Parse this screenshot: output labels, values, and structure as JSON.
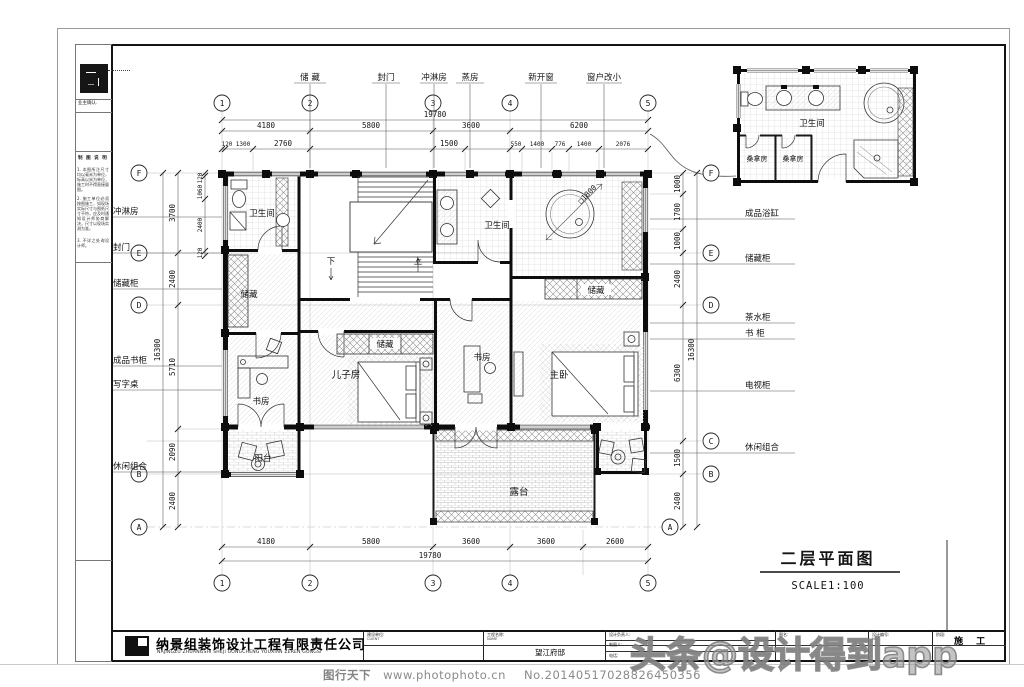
{
  "footer": {
    "brand": "图行天下",
    "url": "www.photophoto.cn",
    "serial": "No.20140517028826450356"
  },
  "watermark": {
    "text": "头条@设计得到app"
  },
  "title_tag": {
    "title": "二层平面图",
    "scale": "SCALE1:100"
  },
  "sidebar": {
    "confirm": "业主确认.",
    "notes_title": "制 图 说 明",
    "notes": [
      "1. 本图所注尺寸均以毫米为单位，标高以米为单位，施工时不得直接量图。",
      "2. 施工单位必须按图施工，如现场实际尺寸与图纸尺寸不符，应及时通知设计师协商解决，尺寸以现场实测为准。",
      "3. 不详之处询设计师。"
    ]
  },
  "titleblock": {
    "company": "纳景组装饰设计工程有限责任公司",
    "company_en": "NAJINGZU ZHUANGSHI SHEJI GONGCHENG YOUXIAN ZEREN GONGSI",
    "client_label": "建设单位:",
    "client_sub": "CLIENT",
    "project_label": "工程名称:",
    "project_sub": "NAME",
    "project_value": "望江府邸",
    "director_label": "设计负责人:",
    "drafter_label": "制图人:",
    "phone_label": "电话:",
    "sheet_label": "图名:",
    "no_label": "设计编号:",
    "no_sub": "NO.",
    "stage_label": "阶段:",
    "stage_value": "施 工"
  },
  "axes": {
    "top": [
      "1",
      "2",
      "3",
      "4",
      "5"
    ],
    "bottom": [
      "1",
      "2",
      "3",
      "4",
      "5"
    ],
    "left": [
      "F",
      "E",
      "D",
      "B",
      "A"
    ],
    "right": [
      "F",
      "E",
      "D",
      "C",
      "B",
      "A"
    ]
  },
  "dims": {
    "top1": [
      "4180",
      "5800",
      "3600",
      "6200"
    ],
    "top_total": "19780",
    "top2": [
      "120",
      "1300",
      "2760",
      "1500",
      "550",
      "1400",
      "776",
      "1400",
      "2076"
    ],
    "bottom": [
      "4180",
      "5800",
      "3600",
      "3600",
      "2600"
    ],
    "bottom_total": "19780",
    "left_outer": [
      "3700",
      "2400",
      "5710",
      "2090",
      "2400"
    ],
    "left_total": "16300",
    "left_inner": [
      "120",
      "1060",
      "2400",
      "120"
    ],
    "right_outer": [
      "1000",
      "1700",
      "1000",
      "2400",
      "6300",
      "1500",
      "2400"
    ],
    "right_total": "16300"
  },
  "callouts": {
    "top": [
      "储 藏",
      "封门",
      "冲淋房",
      "蒸房",
      "新开窗",
      "窗户改小"
    ],
    "left": [
      "冲淋房",
      "封门",
      "储藏柜",
      "成品书柜",
      "写字桌",
      "休闲组合"
    ],
    "right": [
      "成品浴缸",
      "储藏柜",
      "茶水柜",
      "书  柜",
      "电视柜",
      "休闲组合"
    ]
  },
  "rooms": {
    "wc1": "卫生间",
    "wc2": "卫生间",
    "storage1": "储藏",
    "storage2": "储藏",
    "storage3": "储藏",
    "study1": "书房",
    "study2": "书房",
    "kidroom": "儿子房",
    "master": "主卧",
    "balcony": "阳台",
    "terrace": "露台",
    "down": "下",
    "up": "上",
    "tub_note": "□1800"
  },
  "detail": {
    "wc": "卫生间",
    "sauna1": "桑拿房",
    "sauna2": "桑拿房"
  }
}
